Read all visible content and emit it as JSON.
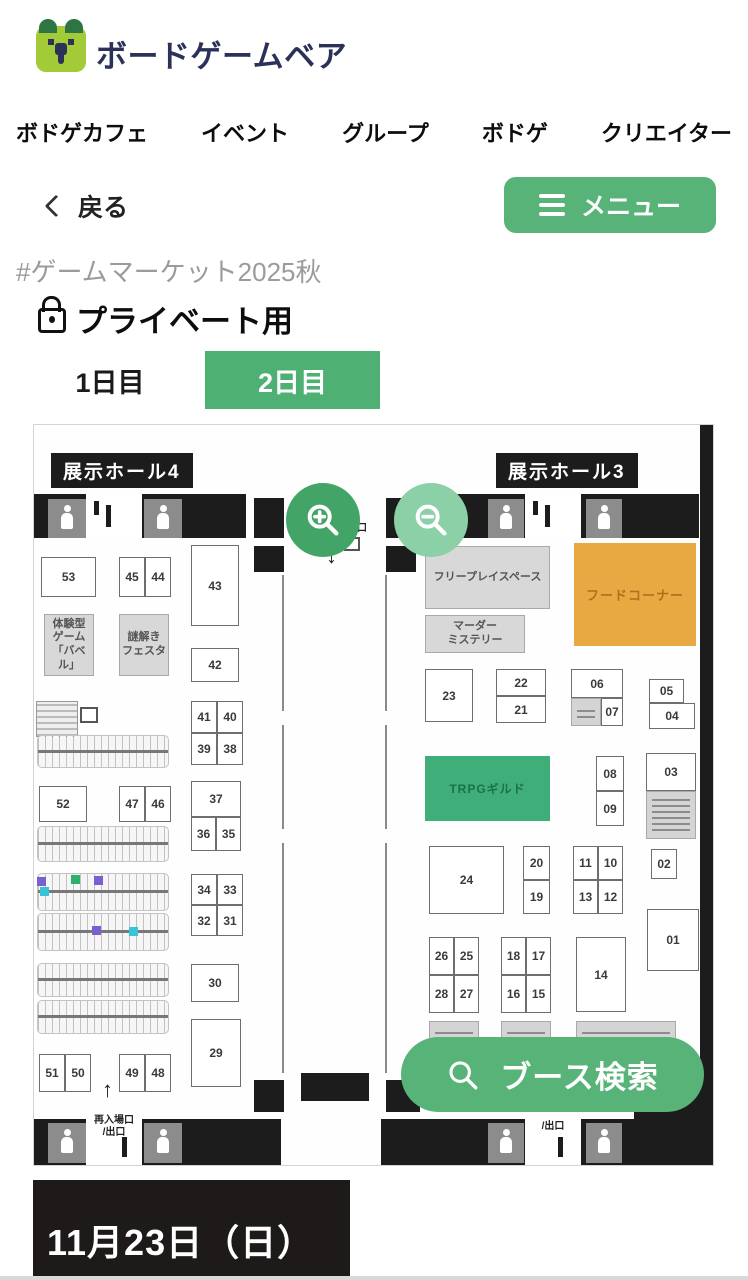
{
  "header": {
    "brand": "ボードゲームベア"
  },
  "nav": {
    "items": [
      "ボドゲカフェ",
      "イベント",
      "グループ",
      "ボドゲ",
      "クリエイター"
    ]
  },
  "toolbar": {
    "back_label": "戻る",
    "menu_label": "メニュー"
  },
  "page": {
    "hashtag": "#ゲームマーケット2025秋",
    "title": "プライベート用",
    "tabs": [
      {
        "label": "1日目",
        "active": false
      },
      {
        "label": "2日目",
        "active": true
      }
    ],
    "date_banner": "11月23日（日）"
  },
  "colors": {
    "brand_navy": "#2b3158",
    "green_primary": "#57b377",
    "green_tab": "#4eb173",
    "green_zoom_in": "#43a467",
    "green_zoom_out": "#8bd0a6",
    "area_green": "#3fae78",
    "area_orange": "#e9a942",
    "wall_black": "#1c1c1c",
    "highlight_purple": "#7b5fd0",
    "highlight_green": "#2fae6e",
    "highlight_cyan": "#38c3d8"
  },
  "map": {
    "hall4_label": "展示ホール4",
    "hall3_label": "展示ホール3",
    "entrance_label": "入場口",
    "reentry_label": "再入場口\n/出口",
    "exit_label": "/出口",
    "search_button": "ブース検索",
    "areas": [
      {
        "name": "free-play-space",
        "label": "フリープレイスペース",
        "t": "gray",
        "x": 391,
        "y": 121,
        "w": 125,
        "h": 63
      },
      {
        "name": "murder-mystery",
        "label": "マーダー\nミステリー",
        "t": "gray",
        "x": 391,
        "y": 190,
        "w": 100,
        "h": 38
      },
      {
        "name": "food-corner",
        "label": "フードコーナー",
        "t": "orange",
        "x": 540,
        "y": 118,
        "w": 122,
        "h": 103
      },
      {
        "name": "trpg-guild",
        "label": "TRPGギルド",
        "t": "green",
        "x": 391,
        "y": 331,
        "w": 125,
        "h": 65
      },
      {
        "name": "taiken-game-babel",
        "label": "体験型\nゲーム\n「バベル」",
        "t": "gray",
        "x": 10,
        "y": 189,
        "w": 50,
        "h": 62
      },
      {
        "name": "nazotoki-festa",
        "label": "謎解き\nフェスタ",
        "t": "gray",
        "x": 85,
        "y": 189,
        "w": 50,
        "h": 62
      },
      {
        "name": "small-info-cell",
        "label": "",
        "t": "fineprint",
        "x": 537,
        "y": 273,
        "w": 30,
        "h": 28
      },
      {
        "name": "info-under-03",
        "label": "",
        "t": "fineprint",
        "x": 612,
        "y": 366,
        "w": 50,
        "h": 48
      },
      {
        "name": "bottom-gray-1",
        "label": "",
        "t": "gray fineprint",
        "x": 395,
        "y": 596,
        "w": 50,
        "h": 45
      },
      {
        "name": "bottom-gray-2",
        "label": "",
        "t": "gray fineprint",
        "x": 467,
        "y": 596,
        "w": 50,
        "h": 45
      },
      {
        "name": "bottom-gray-3",
        "label": "",
        "t": "gray fineprint",
        "x": 542,
        "y": 596,
        "w": 100,
        "h": 45
      }
    ],
    "booths": [
      {
        "label": "53",
        "x": 7,
        "y": 132,
        "w": 55,
        "h": 40
      },
      {
        "label": "45",
        "x": 85,
        "y": 132,
        "w": 26,
        "h": 40
      },
      {
        "label": "44",
        "x": 111,
        "y": 132,
        "w": 26,
        "h": 40
      },
      {
        "label": "43",
        "x": 157,
        "y": 120,
        "w": 48,
        "h": 81
      },
      {
        "label": "42",
        "x": 157,
        "y": 223,
        "w": 48,
        "h": 34
      },
      {
        "label": "41",
        "x": 157,
        "y": 276,
        "w": 26,
        "h": 32
      },
      {
        "label": "40",
        "x": 183,
        "y": 276,
        "w": 26,
        "h": 32
      },
      {
        "label": "39",
        "x": 157,
        "y": 308,
        "w": 26,
        "h": 32
      },
      {
        "label": "38",
        "x": 183,
        "y": 308,
        "w": 26,
        "h": 32
      },
      {
        "label": "52",
        "x": 5,
        "y": 361,
        "w": 48,
        "h": 36
      },
      {
        "label": "47",
        "x": 85,
        "y": 361,
        "w": 26,
        "h": 36
      },
      {
        "label": "46",
        "x": 111,
        "y": 361,
        "w": 26,
        "h": 36
      },
      {
        "label": "37",
        "x": 157,
        "y": 356,
        "w": 50,
        "h": 36
      },
      {
        "label": "36",
        "x": 157,
        "y": 392,
        "w": 25,
        "h": 34
      },
      {
        "label": "35",
        "x": 182,
        "y": 392,
        "w": 25,
        "h": 34
      },
      {
        "label": "34",
        "x": 157,
        "y": 449,
        "w": 26,
        "h": 31
      },
      {
        "label": "33",
        "x": 183,
        "y": 449,
        "w": 26,
        "h": 31
      },
      {
        "label": "32",
        "x": 157,
        "y": 480,
        "w": 26,
        "h": 31
      },
      {
        "label": "31",
        "x": 183,
        "y": 480,
        "w": 26,
        "h": 31
      },
      {
        "label": "30",
        "x": 157,
        "y": 539,
        "w": 48,
        "h": 38
      },
      {
        "label": "29",
        "x": 157,
        "y": 594,
        "w": 50,
        "h": 68
      },
      {
        "label": "51",
        "x": 5,
        "y": 629,
        "w": 26,
        "h": 38
      },
      {
        "label": "50",
        "x": 31,
        "y": 629,
        "w": 26,
        "h": 38
      },
      {
        "label": "49",
        "x": 85,
        "y": 629,
        "w": 26,
        "h": 38
      },
      {
        "label": "48",
        "x": 111,
        "y": 629,
        "w": 26,
        "h": 38
      },
      {
        "label": "23",
        "x": 391,
        "y": 244,
        "w": 48,
        "h": 53
      },
      {
        "label": "22",
        "x": 462,
        "y": 244,
        "w": 50,
        "h": 27
      },
      {
        "label": "21",
        "x": 462,
        "y": 271,
        "w": 50,
        "h": 27
      },
      {
        "label": "06",
        "x": 537,
        "y": 244,
        "w": 52,
        "h": 29
      },
      {
        "label": "07",
        "x": 567,
        "y": 273,
        "w": 22,
        "h": 28
      },
      {
        "label": "05",
        "x": 615,
        "y": 254,
        "w": 35,
        "h": 24
      },
      {
        "label": "04",
        "x": 615,
        "y": 278,
        "w": 46,
        "h": 26
      },
      {
        "label": "08",
        "x": 562,
        "y": 331,
        "w": 28,
        "h": 35
      },
      {
        "label": "09",
        "x": 562,
        "y": 366,
        "w": 28,
        "h": 35
      },
      {
        "label": "03",
        "x": 612,
        "y": 328,
        "w": 50,
        "h": 38
      },
      {
        "label": "24",
        "x": 395,
        "y": 421,
        "w": 75,
        "h": 68
      },
      {
        "label": "20",
        "x": 489,
        "y": 421,
        "w": 27,
        "h": 34
      },
      {
        "label": "19",
        "x": 489,
        "y": 455,
        "w": 27,
        "h": 34
      },
      {
        "label": "11",
        "x": 539,
        "y": 421,
        "w": 25,
        "h": 34
      },
      {
        "label": "10",
        "x": 564,
        "y": 421,
        "w": 25,
        "h": 34
      },
      {
        "label": "13",
        "x": 539,
        "y": 455,
        "w": 25,
        "h": 34
      },
      {
        "label": "12",
        "x": 564,
        "y": 455,
        "w": 25,
        "h": 34
      },
      {
        "label": "02",
        "x": 617,
        "y": 424,
        "w": 26,
        "h": 30
      },
      {
        "label": "01",
        "x": 613,
        "y": 484,
        "w": 52,
        "h": 62
      },
      {
        "label": "26",
        "x": 395,
        "y": 512,
        "w": 25,
        "h": 38
      },
      {
        "label": "25",
        "x": 420,
        "y": 512,
        "w": 25,
        "h": 38
      },
      {
        "label": "28",
        "x": 395,
        "y": 550,
        "w": 25,
        "h": 38
      },
      {
        "label": "27",
        "x": 420,
        "y": 550,
        "w": 25,
        "h": 38
      },
      {
        "label": "18",
        "x": 467,
        "y": 512,
        "w": 25,
        "h": 38
      },
      {
        "label": "17",
        "x": 492,
        "y": 512,
        "w": 25,
        "h": 38
      },
      {
        "label": "16",
        "x": 467,
        "y": 550,
        "w": 25,
        "h": 38
      },
      {
        "label": "15",
        "x": 492,
        "y": 550,
        "w": 25,
        "h": 38
      },
      {
        "label": "14",
        "x": 542,
        "y": 512,
        "w": 50,
        "h": 75
      }
    ],
    "combs": [
      {
        "x": 3,
        "y": 310,
        "w": 132,
        "h": 33
      },
      {
        "x": 3,
        "y": 401,
        "w": 132,
        "h": 36
      },
      {
        "x": 3,
        "y": 448,
        "w": 132,
        "h": 38
      },
      {
        "x": 3,
        "y": 488,
        "w": 132,
        "h": 38
      },
      {
        "x": 3,
        "y": 538,
        "w": 132,
        "h": 34
      },
      {
        "x": 3,
        "y": 575,
        "w": 132,
        "h": 34
      }
    ],
    "highlights": [
      {
        "x": 3,
        "y": 452,
        "c": "#7b5fd0"
      },
      {
        "x": 6,
        "y": 462,
        "c": "#38c3d8"
      },
      {
        "x": 37,
        "y": 450,
        "c": "#2fae6e"
      },
      {
        "x": 60,
        "y": 451,
        "c": "#7b5fd0"
      },
      {
        "x": 58,
        "y": 501,
        "c": "#7b5fd0"
      },
      {
        "x": 95,
        "y": 502,
        "c": "#38c3d8"
      }
    ]
  }
}
